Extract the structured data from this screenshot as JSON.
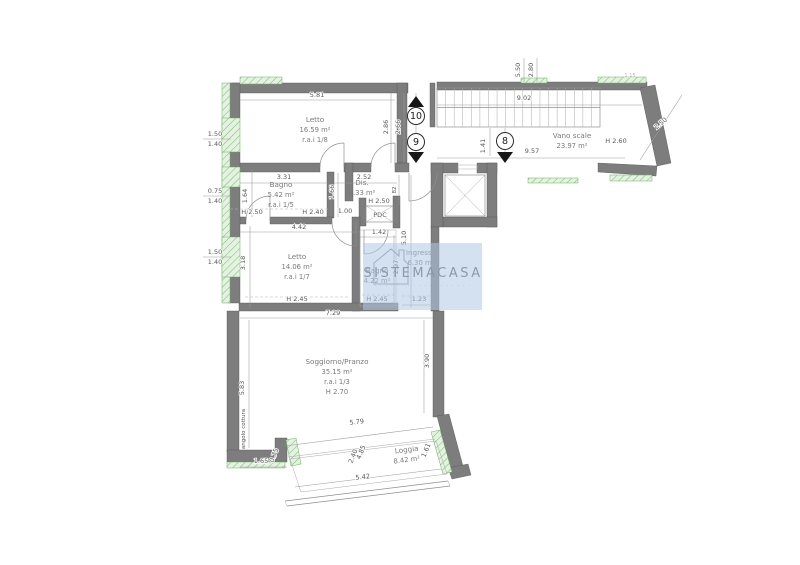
{
  "title": "Planimetria appartamento",
  "watermark": {
    "brand": "SISTEMACASA",
    "microtext": "· · · · · · · · · · · · · · · · · ·"
  },
  "colors": {
    "wall": "#7d7d7d",
    "window_hatch": "#e4f2e1",
    "window_hatch_line": "#7db874",
    "dim_text": "#585858",
    "room_text": "#7a7a7a",
    "watermark_fill": "#b0c9e4",
    "watermark_text": "#8a97a8",
    "marker": "#1c1c1c"
  },
  "rooms": [
    {
      "name": "letto-1",
      "label": "Letto",
      "area": "16.59 m²",
      "extra": "r.a.i 1/8",
      "x": 315,
      "y": 122
    },
    {
      "name": "bagno-1",
      "label": "Bagno",
      "area": "5.42 m²",
      "extra": "r.a.i 1/5",
      "x": 281,
      "y": 187
    },
    {
      "name": "disimpegno",
      "label": "Dis.",
      "area": "4.33 m²",
      "x": 362,
      "y": 185
    },
    {
      "name": "letto-2",
      "label": "Letto",
      "area": "14.06 m²",
      "extra": "r.a.i 1/7",
      "x": 297,
      "y": 259
    },
    {
      "name": "ingresso",
      "label": "Ingresso",
      "area": "6.30 m²",
      "x": 421,
      "y": 255
    },
    {
      "name": "bagno-2",
      "label": "Bagno",
      "area": "4.22 m²",
      "x": 377,
      "y": 273
    },
    {
      "name": "soggiorno-pranzo",
      "label": "Soggiorno/Pranzo",
      "area": "35.15 m²",
      "extra": "r.a.i 1/3",
      "extra2": "H 2.70",
      "x": 337,
      "y": 364
    },
    {
      "name": "loggia",
      "label": "Loggia",
      "area": "8.42 m²",
      "x": 407,
      "y": 452,
      "rot": -7
    },
    {
      "name": "vano-scale",
      "label": "Vano scale",
      "area": "23.97 m²",
      "x": 572,
      "y": 138
    }
  ],
  "dims": [
    {
      "t": "5.81",
      "x": 317,
      "y": 97
    },
    {
      "t": "2.86",
      "x": 388,
      "y": 127,
      "r": -90
    },
    {
      "t": "2.66",
      "x": 400,
      "y": 127,
      "r": -90
    },
    {
      "t": "1.50",
      "x": 215,
      "y": 136
    },
    {
      "t": "1.40",
      "x": 215,
      "y": 146
    },
    {
      "t": "0.75",
      "x": 215,
      "y": 193
    },
    {
      "t": "1.40",
      "x": 215,
      "y": 203
    },
    {
      "t": "1.50",
      "x": 215,
      "y": 254
    },
    {
      "t": "1.40",
      "x": 215,
      "y": 264
    },
    {
      "t": "1.64",
      "x": 247,
      "y": 196,
      "r": -90
    },
    {
      "t": "3.31",
      "x": 284,
      "y": 179
    },
    {
      "t": "2.52",
      "x": 364,
      "y": 179
    },
    {
      "t": "1.66",
      "x": 334,
      "y": 192,
      "r": -90
    },
    {
      "t": "82",
      "x": 396,
      "y": 190,
      "r": -90,
      "s": 5.5
    },
    {
      "t": "H 2.50",
      "x": 252,
      "y": 214
    },
    {
      "t": "H 2.40",
      "x": 313,
      "y": 214
    },
    {
      "t": "1.00",
      "x": 345,
      "y": 213
    },
    {
      "t": "H 2.50",
      "x": 379,
      "y": 203
    },
    {
      "t": "PDC",
      "x": 380,
      "y": 217,
      "s": 6.5
    },
    {
      "t": "4.42",
      "x": 299,
      "y": 229
    },
    {
      "t": "1.42",
      "x": 379,
      "y": 234
    },
    {
      "t": "3.18",
      "x": 245,
      "y": 263,
      "r": -90
    },
    {
      "t": "5.10",
      "x": 406,
      "y": 238,
      "r": -90
    },
    {
      "t": "2.97",
      "x": 398,
      "y": 267,
      "r": -90
    },
    {
      "t": "H 2.45",
      "x": 297,
      "y": 301
    },
    {
      "t": "H 2.45",
      "x": 377,
      "y": 301
    },
    {
      "t": "1.23",
      "x": 419,
      "y": 301
    },
    {
      "t": "7.29",
      "x": 333,
      "y": 315
    },
    {
      "t": "5.83",
      "x": 244,
      "y": 388,
      "r": -90
    },
    {
      "t": "angolo cottura",
      "x": 245,
      "y": 429,
      "r": -90,
      "s": 5.5
    },
    {
      "t": "3.90",
      "x": 429,
      "y": 361,
      "r": -90
    },
    {
      "t": "5.79",
      "x": 357,
      "y": 424,
      "r": -7
    },
    {
      "t": "4.85",
      "x": 363,
      "y": 453,
      "r": -68
    },
    {
      "t": "2.40",
      "x": 355,
      "y": 457,
      "r": -68
    },
    {
      "t": "1.61",
      "x": 428,
      "y": 451,
      "r": -68
    },
    {
      "t": "5.42",
      "x": 363,
      "y": 479,
      "r": -7
    },
    {
      "t": "1.65",
      "x": 261,
      "y": 463
    },
    {
      "t": "0.75",
      "x": 276,
      "y": 456,
      "r": -68
    },
    {
      "t": "5.50",
      "x": 520,
      "y": 70,
      "r": -90
    },
    {
      "t": "2.80",
      "x": 533,
      "y": 70,
      "r": -90
    },
    {
      "t": "9.02",
      "x": 524,
      "y": 100
    },
    {
      "t": "1.41",
      "x": 485,
      "y": 146,
      "r": -90
    },
    {
      "t": "9.57",
      "x": 532,
      "y": 153
    },
    {
      "t": "H 2.60",
      "x": 616,
      "y": 143
    },
    {
      "t": "2.50",
      "x": 662,
      "y": 125,
      "r": -40
    },
    {
      "t": "1.15",
      "x": 630,
      "y": 77,
      "s": 5,
      "o": 0.45
    }
  ],
  "markers": [
    {
      "t": "10",
      "x": 416,
      "y": 116,
      "arrow": "up",
      "ax": 416,
      "ay": 103
    },
    {
      "t": "9",
      "x": 416,
      "y": 142,
      "arrow": "down",
      "ax": 416,
      "ay": 156
    },
    {
      "t": "8",
      "x": 505,
      "y": 141,
      "arrow": "down",
      "ax": 505,
      "ay": 156
    }
  ]
}
